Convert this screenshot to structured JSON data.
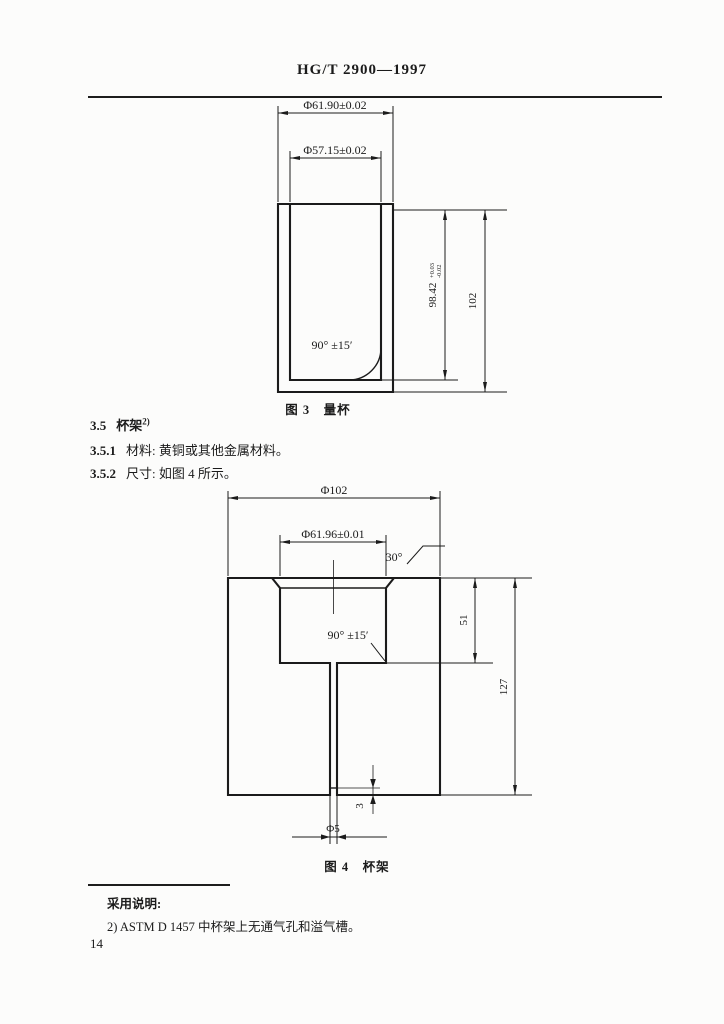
{
  "header": {
    "title": "HG/T 2900—1997"
  },
  "sections": {
    "s1_num": "3.5",
    "s1_title": "杯架",
    "s1_sup": "2)",
    "s2_num": "3.5.1",
    "s2_text": "材料: 黄铜或其他金属材料。",
    "s3_num": "3.5.2",
    "s3_text": "尺寸: 如图 4 所示。"
  },
  "fig3": {
    "caption": "图 3　量杯",
    "outer_dia": "Φ61.90±0.02",
    "inner_dia": "Φ57.15±0.02",
    "depth_main": "98.42",
    "depth_tol_up": "+0.03",
    "depth_tol_dn": "-0.02",
    "height": "102",
    "angle": "90° ±15′"
  },
  "fig4": {
    "caption": "图 4　杯架",
    "outer_dia": "Φ102",
    "bore_dia": "Φ61.96±0.01",
    "chamfer": "30°",
    "angle": "90° ±15′",
    "cavity_depth": "51",
    "height": "127",
    "base_gap": "3",
    "hole_dia": "Φ5"
  },
  "footnote": {
    "heading": "采用说明:",
    "item": "2) ASTM D 1457 中杯架上无通气孔和溢气槽。"
  },
  "page_number": "14"
}
